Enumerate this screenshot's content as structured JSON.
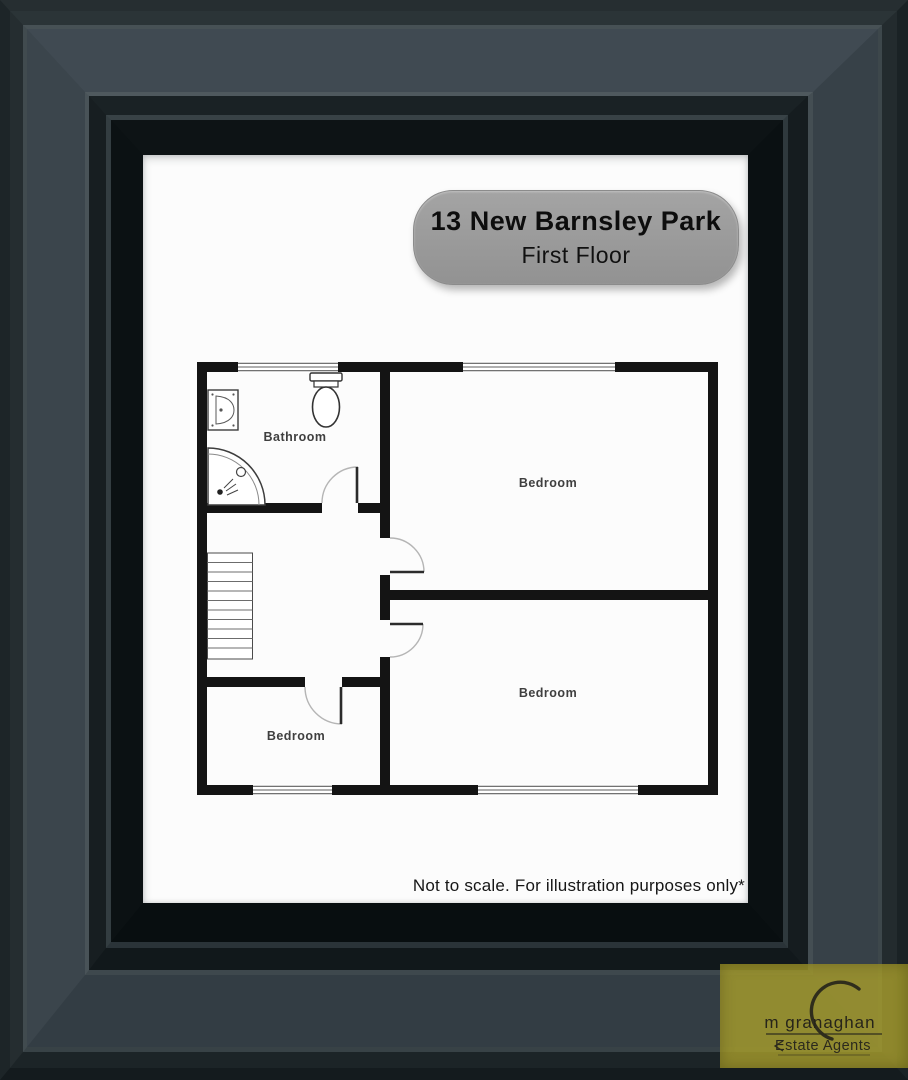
{
  "badge": {
    "line1": "13 New Barnsley Park",
    "line2": "First Floor"
  },
  "floorplan": {
    "rooms": [
      {
        "id": "bathroom",
        "label": "Bathroom"
      },
      {
        "id": "bedroom-top-right",
        "label": "Bedroom"
      },
      {
        "id": "bedroom-bottom-right",
        "label": "Bedroom"
      },
      {
        "id": "bedroom-bottom-left",
        "label": "Bedroom"
      }
    ],
    "disclaimer": "Not to scale. For illustration purposes only*"
  },
  "logo": {
    "brand": "m granaghan",
    "tagline": "Estate Agents"
  },
  "colors": {
    "frame_face": "#39434a",
    "frame_dark": "#0c1214",
    "mat": "#fcfcfc",
    "badge_fill": "#9b9b9b",
    "wall": "#141414",
    "logo_olive": "#a69c2c",
    "logo_text": "#26241a"
  }
}
